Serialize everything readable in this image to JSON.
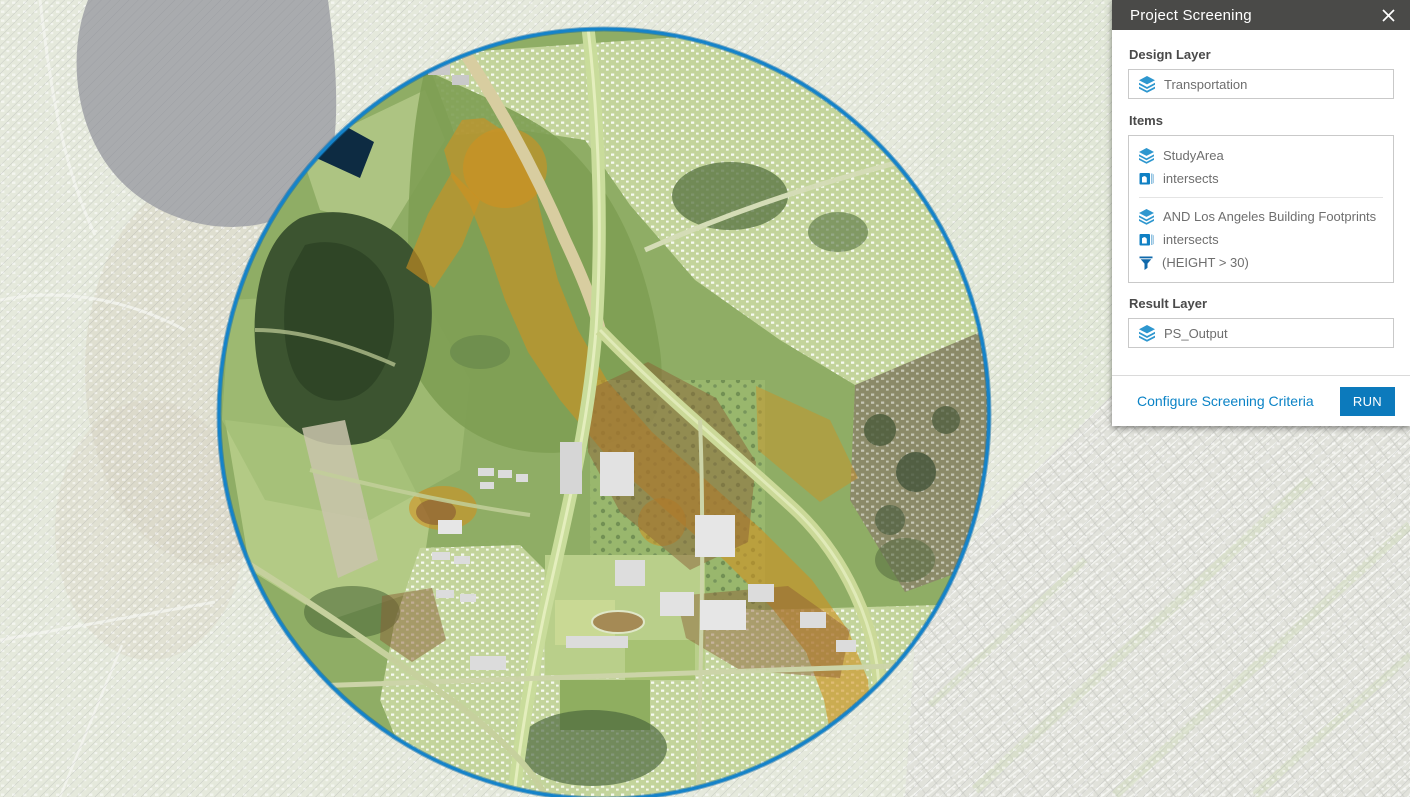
{
  "panel": {
    "title": "Project Screening",
    "close_icon": "close-icon",
    "design_layer": {
      "label": "Design Layer",
      "value": "Transportation",
      "icon": "layers-icon"
    },
    "items": {
      "label": "Items",
      "groups": [
        {
          "layer": "StudyArea",
          "layer_icon": "layers-icon",
          "operator": "intersects",
          "operator_icon": "intersect-icon"
        },
        {
          "layer": "AND Los Angeles Building Footprints",
          "layer_icon": "layers-icon",
          "operator": "intersects",
          "operator_icon": "intersect-icon",
          "filter": "(HEIGHT > 30)",
          "filter_icon": "filter-icon"
        }
      ]
    },
    "result_layer": {
      "label": "Result Layer",
      "value": "PS_Output",
      "icon": "layers-icon"
    },
    "footer": {
      "link": "Configure Screening Criteria",
      "run_button": "RUN"
    }
  },
  "map": {
    "study_area_shape": "circle",
    "study_area_ring_color": "#1583c9",
    "screened_green": "#8fad65",
    "corridor_orange": "#d0911f",
    "basemap_style": "faded aerial with diagonal hatch outside study area"
  },
  "colors": {
    "header_bg": "#4a4a48",
    "accent_blue": "#0b83c6",
    "run_button_bg": "#0c7abc"
  }
}
